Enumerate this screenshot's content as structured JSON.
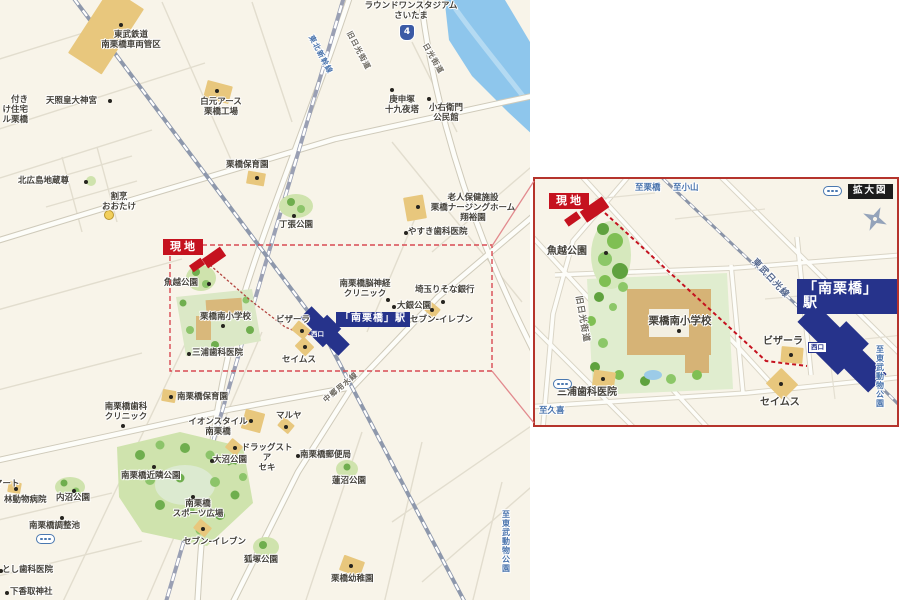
{
  "colors": {
    "map_bg": "#f8f4e9",
    "accent_red": "#c5121f",
    "station_navy": "#26338b",
    "water": "#8ec6ec",
    "park_green": "#cfe3ad",
    "tree_green": "#6fae4e",
    "building_tan": "#e8c77d",
    "label_text": "#45423b",
    "direction_blue": "#4a74ad",
    "inset_border": "#b5342c"
  },
  "left_map": {
    "pois": {
      "round1": "ラウンドワンスタジアム\nさいたま",
      "route4": "4",
      "tobu_depot": "東武鉄道\n南栗橋車両管区",
      "hakugen": "白元アース\n栗橋工場",
      "tensho": "天照皇大神宮",
      "cutoff_housing": "付き\nけ住宅\nル栗橋",
      "kitahiroshima": "北広島地蔵尊",
      "kappo_otake": "割烹\nおおたけ",
      "kurihashi_hoikuen": "栗橋保育園",
      "chohari_park": "丁張公園",
      "koshinzuka": "庚申塚\n十九夜塔",
      "koemon": "小右衛門\n公民館",
      "nursing_home": "老人保健施設\n栗橋ナージングホーム\n翔裕園",
      "yasuki": "やすき歯科医院",
      "neuro_clinic": "南栗橋脳神経\nクリニック",
      "oogin_park": "大銀公園",
      "risona_bank": "埼玉りそな銀行",
      "seven_east": "セブン-イレブン",
      "genchi": "現地",
      "uokoshi_park": "魚越公園",
      "school": "栗橋南小学校",
      "miura": "三浦歯科医院",
      "pizala": "ビザーラ",
      "seimus": "セイムス",
      "station": "「南栗橋」駅",
      "nishiguchi": "西口",
      "dental_clinic": "南栗橋歯科\nクリニック",
      "minami_hoikuen": "南栗橋保育園",
      "aeon": "イオンスタイル\n南栗橋",
      "maruya": "マルヤ",
      "drug_seki": "ドラッグストア\nセキ",
      "onuma_park": "大沼公園",
      "kinrin_park": "南栗橋近隣公園",
      "sports": "南栗橋\nスポーツ広場",
      "seven_south": "セブン-イレブン",
      "mart": "マート",
      "hayashi_vet": "林動物病院",
      "uchinuma_park": "内沼公園",
      "choseichi": "南栗橋調整池",
      "toshi_dental": "とし歯科医院",
      "shimokatori": "下香取神社",
      "post_office": "南栗橋郵便局",
      "hasunuma_park": "蓮沼公園",
      "kozuka_park": "狐塚公園",
      "yochien": "栗橋幼稚園",
      "shinkansen": "東北新幹線",
      "kyu_nikko": "旧日光街道",
      "nikko_kaido": "日光街道",
      "nakasen": "中郷用水線",
      "to_tobu": "至東武動物公園"
    }
  },
  "inset_map": {
    "pois": {
      "kakudaizu": "拡大図",
      "genchi": "現地",
      "uokoshi_park": "魚越公園",
      "school": "栗橋南小学校",
      "miura": "三浦歯科医院",
      "pizala": "ビザーラ",
      "seimus": "セイムス",
      "station": "「南栗橋」駅",
      "nishiguchi": "西口",
      "tobu_line": "東武日光線",
      "kyu_nikko": "旧日光街道",
      "to_kurihashi": "至栗橋",
      "to_oyama": "至小山",
      "to_kuki": "至久喜",
      "to_tobu": "至東武動物公園"
    }
  }
}
